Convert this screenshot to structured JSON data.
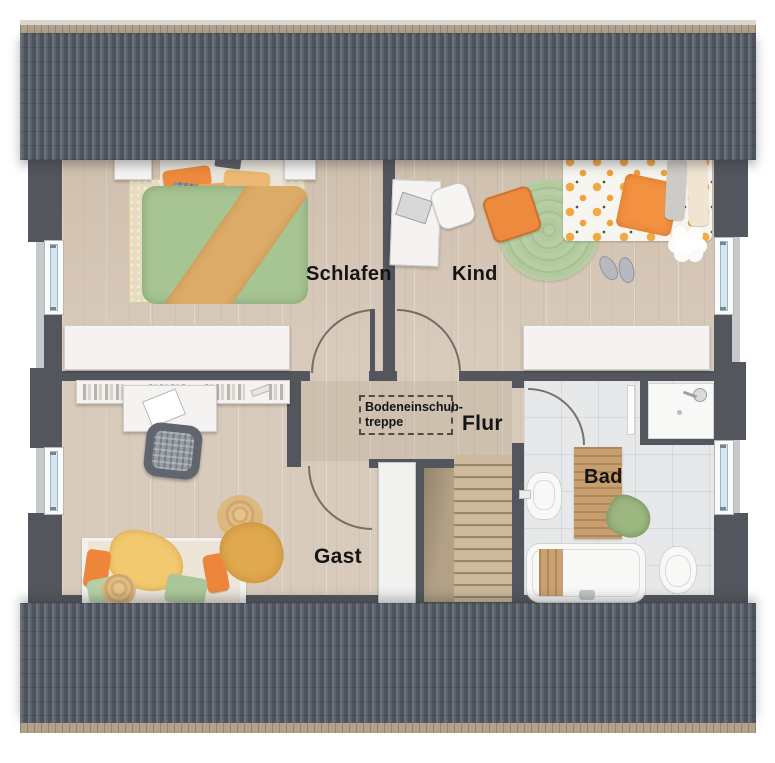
{
  "plan_title": "attic-floor-plan",
  "rooms": {
    "schlafen": {
      "label": "Schlafen"
    },
    "kind": {
      "label": "Kind"
    },
    "flur": {
      "label": "Flur"
    },
    "gast": {
      "label": "Gast"
    },
    "bad": {
      "label": "Bad"
    }
  },
  "annotations": {
    "attic_hatch": {
      "line1": "Bodeneinschub-",
      "line2": "treppe"
    }
  },
  "colors": {
    "roof": "#59606a",
    "roof_ridge": "#b2a28c",
    "wall": "#53575d",
    "floor_wood": "#d9cbbc",
    "bath_tile": "#e7e8ea",
    "duvet_green": "#a7c493",
    "accent_orange": "#ee8a3d",
    "accent_tan": "#dcab67",
    "round_rug_green": "#aec89a",
    "rug_beige": "#e7dcc0",
    "window_glass": "#d3e6f2",
    "furniture_white": "#f4f3f1"
  }
}
